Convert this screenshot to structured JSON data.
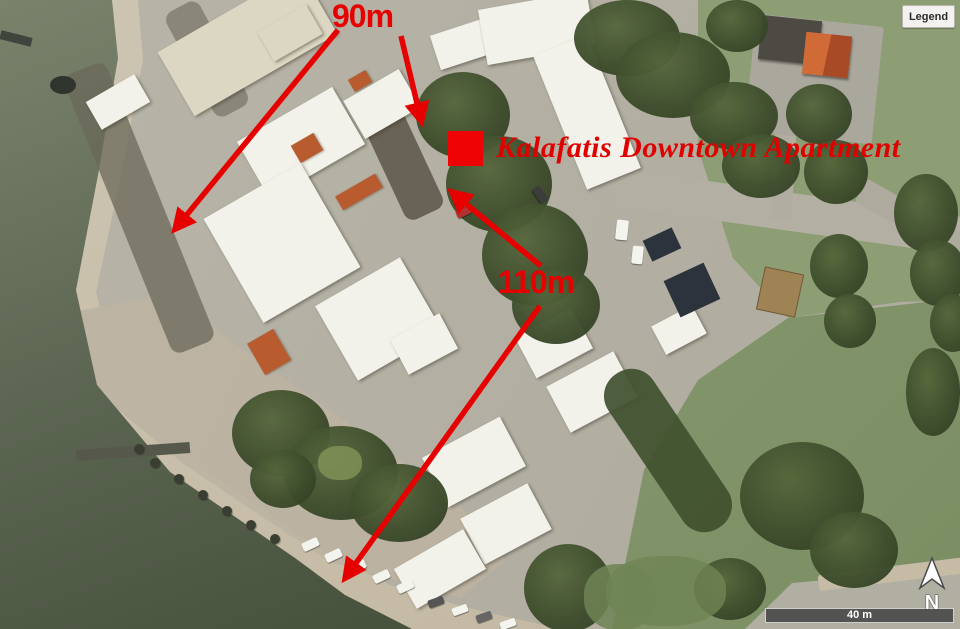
{
  "legend": {
    "button_label": "Legend"
  },
  "annotations": {
    "property_label": "Kalafatis Downtown Apartment",
    "distances": [
      {
        "text": "90m"
      },
      {
        "text": "110m"
      }
    ],
    "marker_color": "#ee0404",
    "annotation_color": "#e60000"
  },
  "scale_bar": {
    "label": "40 m"
  },
  "compass": {
    "label": "N"
  },
  "map_palette": {
    "water": "#5d6753",
    "sand": "#c9c0ad",
    "land": "#b3b0a3",
    "grass": "#879a6f",
    "trees": "#3d4c2b",
    "buildings": "#f2f1ea",
    "orange_roof": "#b85c30"
  }
}
